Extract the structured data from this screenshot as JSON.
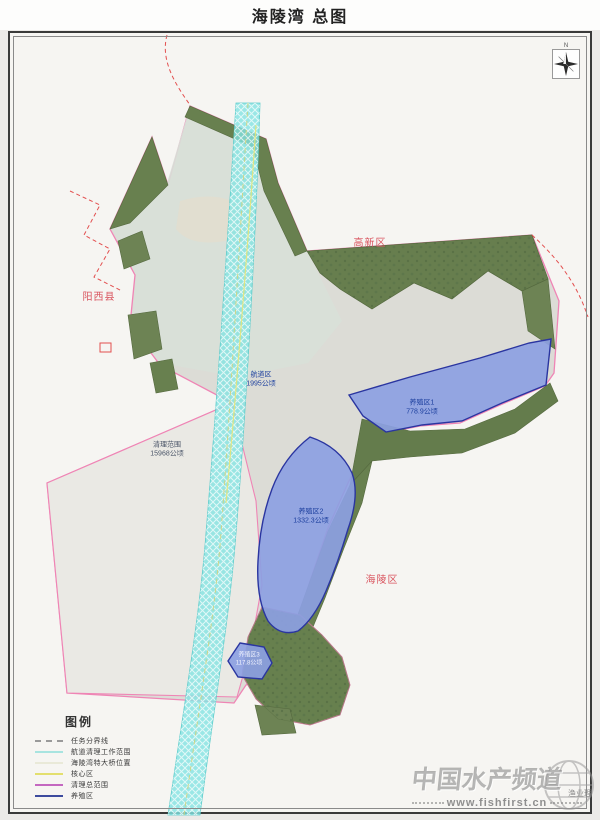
{
  "page": {
    "title": "海陵湾 总图"
  },
  "map": {
    "region_labels": {
      "gaoxin": "高新区",
      "yangxi": "阳西县",
      "hailing": "海陵区"
    },
    "area_labels": {
      "channel": {
        "name": "航道区",
        "area": "1995公顷"
      },
      "cleanup": {
        "name": "清理范围",
        "area": "15968公顷"
      },
      "zone1": {
        "name": "养殖区1",
        "area": "778.9公顷"
      },
      "zone2": {
        "name": "养殖区2",
        "area": "1332.3公顷"
      },
      "zone3": {
        "name": "养殖区3",
        "area": "117.8公顷"
      }
    },
    "compass": {
      "north_label": "N"
    }
  },
  "legend": {
    "title": "图例",
    "items": [
      {
        "label": "任务分界线",
        "color": "#9a9a9a",
        "line_style": "dashed"
      },
      {
        "label": "航道清理工作范围",
        "color": "#a8e4e0",
        "line_style": "solid"
      },
      {
        "label": "海陵湾特大桥位置",
        "color": "#e9e9d8",
        "line_style": "solid"
      },
      {
        "label": "核心区",
        "color": "#e3df6e",
        "line_style": "solid"
      },
      {
        "label": "清理总范围",
        "color": "#c468c0",
        "line_style": "solid"
      },
      {
        "label": "养殖区",
        "color": "#3d4b9e",
        "line_style": "solid"
      }
    ]
  },
  "watermark": {
    "brand": "中国水产频道",
    "url": "www.fishfirst.cn",
    "note": "渔业理"
  },
  "colors": {
    "boundary_pink": "#ef85b5",
    "task_line_red": "#e34f4f",
    "channel_cyan": "#83e4e2",
    "zone_fill": "#8c9fe2",
    "zone_stroke": "#2a35a0",
    "core_yellow": "#e9e470",
    "region_label_red": "#d9545e",
    "area_label_navy": "#1c3f9e",
    "vegetation_green": "#68804f"
  }
}
